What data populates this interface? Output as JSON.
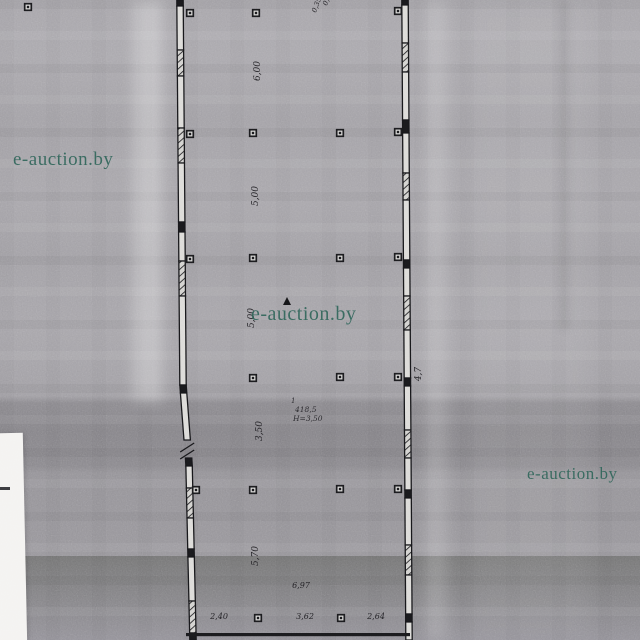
{
  "watermark": {
    "text": "e-auction.by",
    "color": "#2e6156",
    "instances": [
      {
        "x": 13,
        "y": 149,
        "size": 19
      },
      {
        "x": 251,
        "y": 303,
        "size": 20
      },
      {
        "x": 527,
        "y": 464,
        "size": 17
      }
    ]
  },
  "plan": {
    "ink_color": "#17171a",
    "paper_light": "#a9a7ac",
    "paper_band": "#8c8a8f",
    "paper_lower": "#97959a",
    "room_label": {
      "number": "1",
      "area": "418,5",
      "height": "H=3,50",
      "x": 291,
      "y": 403
    },
    "dims_vertical": [
      {
        "x": 260,
        "y": 71,
        "text": "6,00"
      },
      {
        "x": 258,
        "y": 196,
        "text": "5,00"
      },
      {
        "x": 254,
        "y": 318,
        "text": "5,00"
      },
      {
        "x": 262,
        "y": 431,
        "text": "3,50"
      },
      {
        "x": 258,
        "y": 556,
        "text": "5,70"
      },
      {
        "x": 421,
        "y": 374,
        "text": "4,7"
      }
    ],
    "dims_horizontal": [
      {
        "x": 219,
        "y": 619,
        "text": "2,40"
      },
      {
        "x": 305,
        "y": 619,
        "text": "3,62"
      },
      {
        "x": 376,
        "y": 619,
        "text": "2,64"
      },
      {
        "x": 301,
        "y": 588,
        "text": "6,97"
      }
    ],
    "top_annotations": [
      {
        "x": 327,
        "y": 6,
        "rot": -70,
        "text": "0,22"
      },
      {
        "x": 316,
        "y": 13,
        "rot": -70,
        "text": "0,35"
      }
    ],
    "markers": [
      [
        28,
        7
      ],
      [
        190,
        13
      ],
      [
        256,
        13
      ],
      [
        398,
        11
      ],
      [
        190,
        134
      ],
      [
        253,
        133
      ],
      [
        340,
        133
      ],
      [
        398,
        132
      ],
      [
        190,
        259
      ],
      [
        253,
        258
      ],
      [
        340,
        258
      ],
      [
        398,
        257
      ],
      [
        253,
        378
      ],
      [
        340,
        377
      ],
      [
        398,
        377
      ],
      [
        196,
        490
      ],
      [
        253,
        490
      ],
      [
        340,
        489
      ],
      [
        398,
        489
      ],
      [
        258,
        618
      ],
      [
        341,
        618
      ]
    ],
    "door_mark": {
      "x": 287,
      "y": 301
    },
    "bottom_wall": {
      "x0": 186,
      "x1": 410,
      "y": 633
    },
    "walls": [
      {
        "name": "left-wall",
        "points": [
          [
            180,
            0
          ],
          [
            183,
            385
          ],
          [
            186,
            425
          ],
          [
            189,
            463
          ],
          [
            193,
            640
          ]
        ],
        "segments": [
          {
            "y0": 0,
            "y1": 6,
            "t": "solid"
          },
          {
            "y0": 6,
            "y1": 50,
            "t": "hollow"
          },
          {
            "y0": 50,
            "y1": 76,
            "t": "hatch"
          },
          {
            "y0": 76,
            "y1": 128,
            "t": "hollow"
          },
          {
            "y0": 128,
            "y1": 163,
            "t": "hatch"
          },
          {
            "y0": 163,
            "y1": 222,
            "t": "hollow"
          },
          {
            "y0": 222,
            "y1": 232,
            "t": "solid"
          },
          {
            "y0": 232,
            "y1": 261,
            "t": "hollow"
          },
          {
            "y0": 261,
            "y1": 296,
            "t": "hatch"
          },
          {
            "y0": 296,
            "y1": 385,
            "t": "hollow"
          },
          {
            "y0": 385,
            "y1": 393,
            "t": "solid"
          },
          {
            "y0": 393,
            "y1": 440,
            "t": "hollow"
          },
          {
            "y0": 440,
            "y1": 458,
            "t": "break"
          },
          {
            "y0": 458,
            "y1": 466,
            "t": "solid"
          },
          {
            "y0": 466,
            "y1": 488,
            "t": "hollow"
          },
          {
            "y0": 488,
            "y1": 518,
            "t": "hatch"
          },
          {
            "y0": 518,
            "y1": 549,
            "t": "hollow"
          },
          {
            "y0": 549,
            "y1": 557,
            "t": "solid"
          },
          {
            "y0": 557,
            "y1": 601,
            "t": "hollow"
          },
          {
            "y0": 601,
            "y1": 633,
            "t": "hatch"
          },
          {
            "y0": 633,
            "y1": 640,
            "t": "solid"
          }
        ]
      },
      {
        "name": "right-wall",
        "points": [
          [
            405,
            0
          ],
          [
            409,
            640
          ]
        ],
        "segments": [
          {
            "y0": 0,
            "y1": 5,
            "t": "solid"
          },
          {
            "y0": 5,
            "y1": 43,
            "t": "hollow"
          },
          {
            "y0": 43,
            "y1": 72,
            "t": "hatch"
          },
          {
            "y0": 72,
            "y1": 120,
            "t": "hollow"
          },
          {
            "y0": 120,
            "y1": 133,
            "t": "solid"
          },
          {
            "y0": 133,
            "y1": 173,
            "t": "hollow"
          },
          {
            "y0": 173,
            "y1": 200,
            "t": "hatch"
          },
          {
            "y0": 200,
            "y1": 260,
            "t": "hollow"
          },
          {
            "y0": 260,
            "y1": 268,
            "t": "solid"
          },
          {
            "y0": 268,
            "y1": 296,
            "t": "hollow"
          },
          {
            "y0": 296,
            "y1": 330,
            "t": "hatch"
          },
          {
            "y0": 330,
            "y1": 378,
            "t": "hollow"
          },
          {
            "y0": 378,
            "y1": 386,
            "t": "solid"
          },
          {
            "y0": 386,
            "y1": 430,
            "t": "hollow"
          },
          {
            "y0": 430,
            "y1": 458,
            "t": "hatch"
          },
          {
            "y0": 458,
            "y1": 490,
            "t": "hollow"
          },
          {
            "y0": 490,
            "y1": 498,
            "t": "solid"
          },
          {
            "y0": 498,
            "y1": 545,
            "t": "hollow"
          },
          {
            "y0": 545,
            "y1": 575,
            "t": "hatch"
          },
          {
            "y0": 575,
            "y1": 614,
            "t": "hollow"
          },
          {
            "y0": 614,
            "y1": 622,
            "t": "solid"
          },
          {
            "y0": 622,
            "y1": 640,
            "t": "hollow"
          }
        ]
      }
    ]
  }
}
